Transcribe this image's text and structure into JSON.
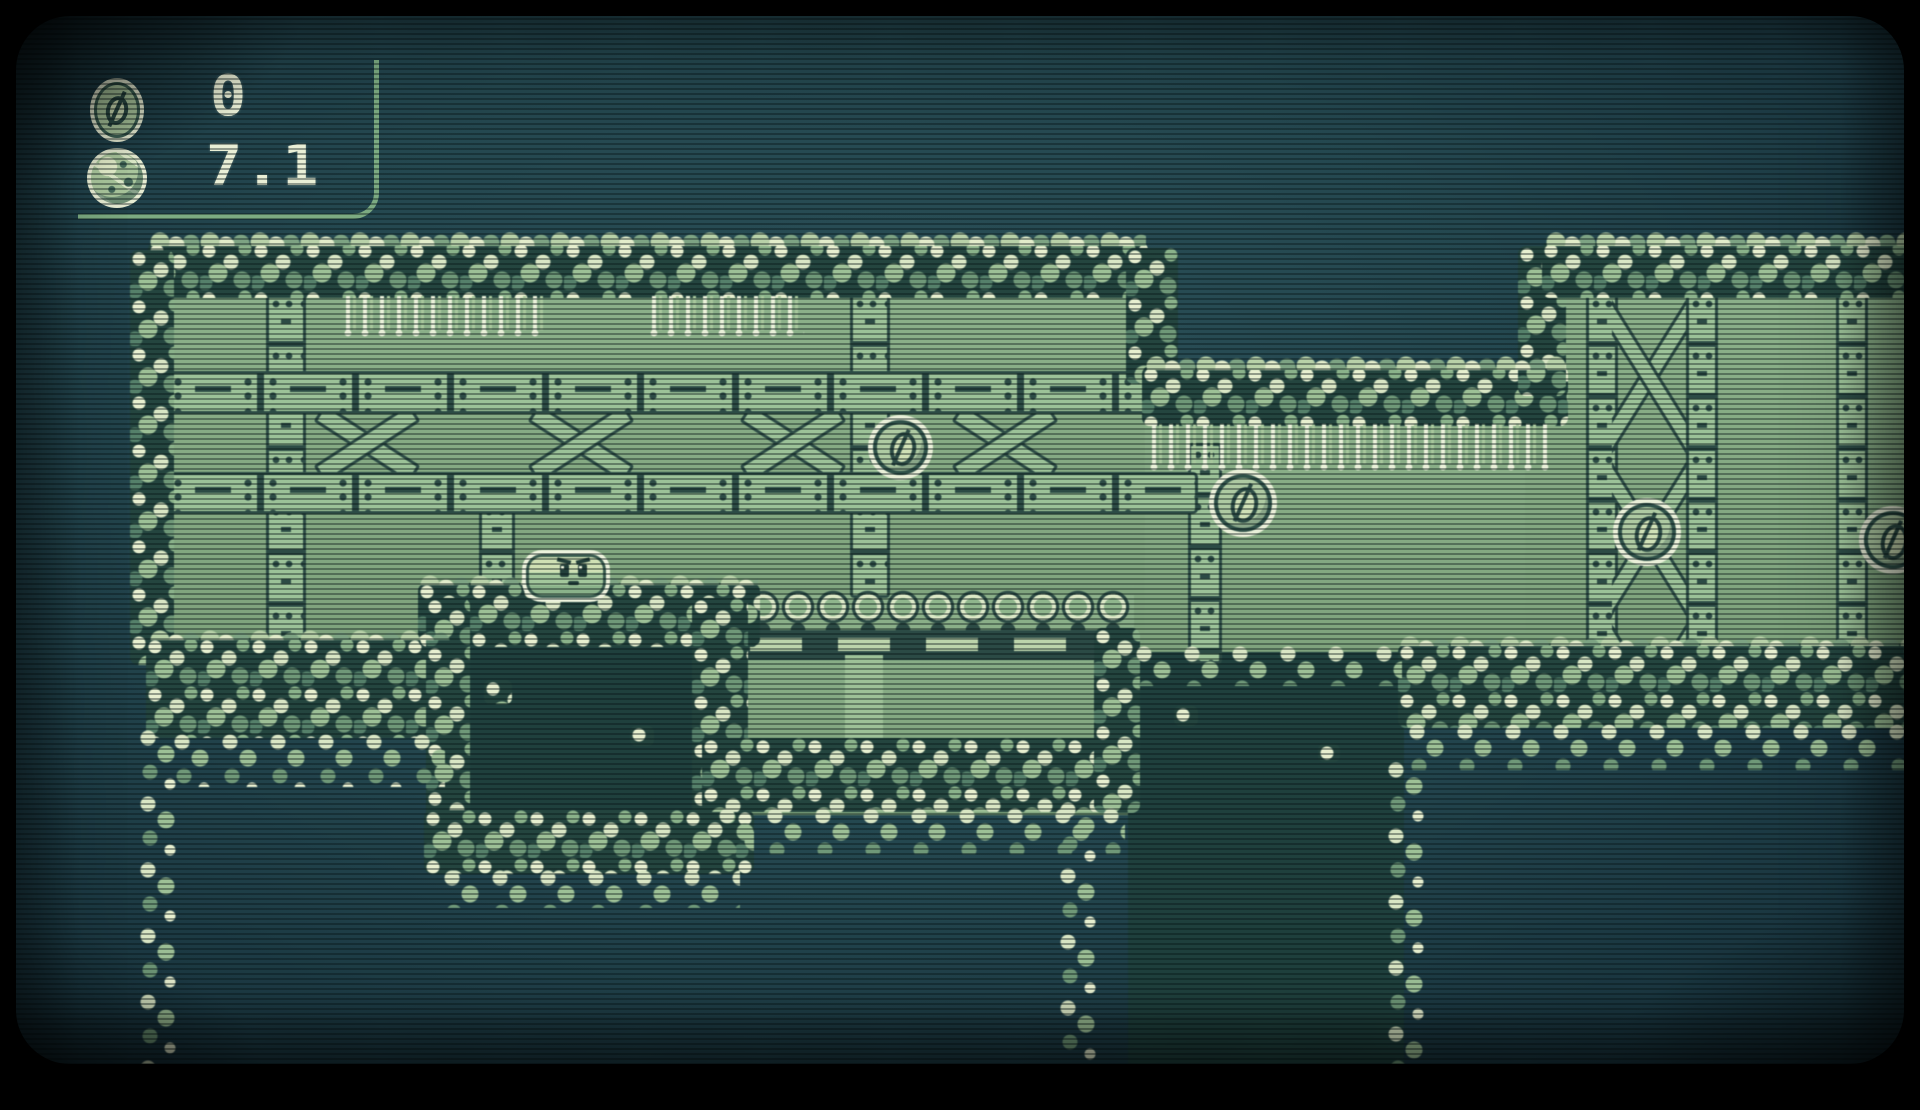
{
  "hud": {
    "coin_counter": {
      "icon": "coin-icon",
      "value": "0"
    },
    "depth_meter": {
      "icon": "yarn-ball-icon",
      "value": "7.1"
    }
  },
  "entities": {
    "player": {
      "label": "player-blob",
      "x": 522,
      "y": 550,
      "w": 80,
      "h": 44,
      "facing": "right"
    },
    "coins": [
      {
        "x": 873,
        "y": 420,
        "d": 55
      },
      {
        "x": 1214,
        "y": 474,
        "d": 58
      },
      {
        "x": 1618,
        "y": 503,
        "d": 58
      },
      {
        "x": 1864,
        "y": 511,
        "d": 58
      }
    ]
  },
  "palette": {
    "background_teal": "#24474f",
    "panel_green": "#86ad84",
    "girder_green": "#9cc298",
    "outline_dark": "#2c4b45",
    "rock_light": "#e7efcf",
    "pit_dark": "#1f403d",
    "hud_text": "#e9efd6",
    "hud_line": "#7cab82"
  }
}
